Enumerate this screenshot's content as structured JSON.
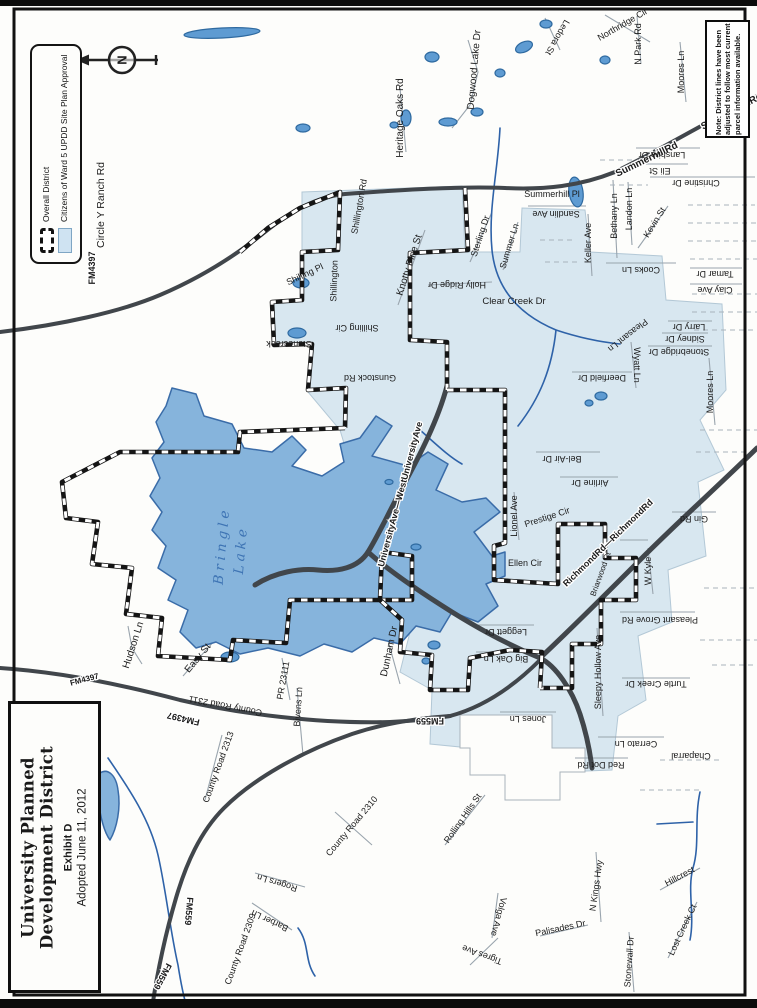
{
  "document": {
    "title_box": {
      "line1": "University Planned",
      "line2": "Development District",
      "exhibit": "Exhibit D",
      "adopted": "Adopted June 11, 2012"
    },
    "legend": {
      "items": [
        {
          "label": "Overall District",
          "swatch": "dashed-boundary"
        },
        {
          "label": "Citizens of Ward 5 UPDD Site Plan Approval",
          "swatch": "light-blue-fill"
        }
      ]
    },
    "note": "Note: District lines have been adjusted to follow most current parcel information available.",
    "north_arrow_letter": "N",
    "lake_label": "Bringle Lake",
    "colors": {
      "district_fill": "#d8e7f0",
      "lake_fill": "#86b4dc",
      "lake_stroke": "#3a6ca8",
      "road": "#41464b",
      "creek": "#2e62a8",
      "label": "#1b1b1b"
    },
    "street_labels": [
      {
        "t": "Circle Y Ranch Rd",
        "x": 104,
        "y": 205,
        "r": -90,
        "s": 10.5
      },
      {
        "t": "FM4397",
        "x": 95,
        "y": 268,
        "r": -90,
        "s": 9,
        "h": 1
      },
      {
        "t": "Heritage Oaks Rd",
        "x": 403,
        "y": 118,
        "r": -90
      },
      {
        "t": "Dogwood  Lake Dr",
        "x": 477,
        "y": 70,
        "r": -85
      },
      {
        "t": "Ledora St",
        "x": 555,
        "y": 36,
        "r": 120,
        "s": 9
      },
      {
        "t": "Northridge Cir",
        "x": 624,
        "y": 27,
        "r": -30,
        "s": 9
      },
      {
        "t": "N Park Rd",
        "x": 641,
        "y": 44,
        "r": -90,
        "s": 9
      },
      {
        "t": "Moores Ln",
        "x": 684,
        "y": 72,
        "r": -90,
        "s": 9
      },
      {
        "t": "SummerhillRd",
        "x": 648,
        "y": 162,
        "r": -26,
        "s": 10,
        "h": 1
      },
      {
        "t": "SummerhillRd",
        "x": 733,
        "y": 114,
        "r": -28,
        "s": 10,
        "h": 1
      },
      {
        "t": "Lanshire Dr",
        "x": 662,
        "y": 152,
        "r": 180,
        "s": 9
      },
      {
        "t": "Eli St",
        "x": 660,
        "y": 168,
        "r": 180,
        "s": 9
      },
      {
        "t": "Christine Dr",
        "x": 696,
        "y": 180,
        "r": 180,
        "s": 9
      },
      {
        "t": "Summerhill Pl",
        "x": 552,
        "y": 197,
        "r": 0,
        "s": 9
      },
      {
        "t": "Sandlin Ave",
        "x": 556,
        "y": 211,
        "r": 180,
        "s": 9
      },
      {
        "t": "Bethany Ln",
        "x": 617,
        "y": 216,
        "r": -90,
        "s": 9
      },
      {
        "t": "Landon Ln",
        "x": 632,
        "y": 209,
        "r": -90,
        "s": 9
      },
      {
        "t": "Kevin St",
        "x": 657,
        "y": 224,
        "r": -58,
        "s": 9
      },
      {
        "t": "Keller Ave",
        "x": 591,
        "y": 243,
        "r": -90,
        "s": 9
      },
      {
        "t": "Cooks Ln",
        "x": 641,
        "y": 267,
        "r": 180,
        "s": 9
      },
      {
        "t": "Tamar Dr",
        "x": 715,
        "y": 271,
        "r": 180,
        "s": 9
      },
      {
        "t": "Clay Ave",
        "x": 715,
        "y": 287,
        "r": 180,
        "s": 9
      },
      {
        "t": "Knotty Pine St",
        "x": 412,
        "y": 266,
        "r": -72
      },
      {
        "t": "Holly Ridge Dr",
        "x": 457,
        "y": 282,
        "r": 180,
        "s": 9
      },
      {
        "t": "Clear Creek Dr",
        "x": 514,
        "y": 304,
        "r": 0,
        "s": 9.5
      },
      {
        "t": "Sterling Dr",
        "x": 483,
        "y": 237,
        "r": -72,
        "s": 9
      },
      {
        "t": "Summer Ln",
        "x": 512,
        "y": 247,
        "r": -73,
        "s": 9
      },
      {
        "t": "Shillington Rd",
        "x": 362,
        "y": 207,
        "r": -80,
        "s": 9
      },
      {
        "t": "Shillington",
        "x": 337,
        "y": 281,
        "r": -88,
        "s": 9
      },
      {
        "t": "Shilling Pl",
        "x": 306,
        "y": 277,
        "r": -25,
        "s": 9
      },
      {
        "t": "Shilling Cir",
        "x": 357,
        "y": 325,
        "r": 180,
        "s": 9
      },
      {
        "t": "Stonecreek",
        "x": 289,
        "y": 341,
        "r": 180,
        "s": 9
      },
      {
        "t": "Gunstock Rd",
        "x": 370,
        "y": 375,
        "r": 180,
        "s": 9
      },
      {
        "t": "Larry Dr",
        "x": 689,
        "y": 324,
        "r": 180,
        "s": 9
      },
      {
        "t": "Sidney Dr",
        "x": 685,
        "y": 336,
        "r": 180,
        "s": 9
      },
      {
        "t": "Stonebridge Dr",
        "x": 679,
        "y": 349,
        "r": 180,
        "s": 9
      },
      {
        "t": "Pleasant Ln",
        "x": 626,
        "y": 333,
        "r": 142,
        "s": 9
      },
      {
        "t": "Wyatt Ln",
        "x": 634,
        "y": 365,
        "r": 90,
        "s": 9
      },
      {
        "t": "Deerfield Dr",
        "x": 602,
        "y": 375,
        "r": 180,
        "s": 9
      },
      {
        "t": "Moores Ln",
        "x": 713,
        "y": 392,
        "r": -90,
        "s": 9
      },
      {
        "t": "Bel-Air Dr",
        "x": 562,
        "y": 456,
        "r": 180,
        "s": 9
      },
      {
        "t": "Airline Dr",
        "x": 590,
        "y": 480,
        "r": 180,
        "s": 9
      },
      {
        "t": "UniversityAve—WestUniversityAve",
        "x": 403,
        "y": 495,
        "r": -75,
        "s": 9,
        "h": 1
      },
      {
        "t": "Lionel Ave",
        "x": 517,
        "y": 516,
        "r": -90,
        "s": 9
      },
      {
        "t": "Prestige Cir",
        "x": 548,
        "y": 520,
        "r": -18,
        "s": 9
      },
      {
        "t": "Ellen Cir",
        "x": 525,
        "y": 566,
        "r": 0,
        "s": 9
      },
      {
        "t": "RichmondRd—RichmondRd",
        "x": 610,
        "y": 545,
        "r": -44,
        "s": 9,
        "h": 1
      },
      {
        "t": "Briarwood Ct",
        "x": 603,
        "y": 575,
        "r": -70,
        "s": 8
      },
      {
        "t": "Gin Rd",
        "x": 694,
        "y": 516,
        "r": 180,
        "s": 9
      },
      {
        "t": "W Kyle",
        "x": 651,
        "y": 571,
        "r": -90,
        "s": 9
      },
      {
        "t": "Pleasant Grove Rd",
        "x": 660,
        "y": 617,
        "r": 180,
        "s": 9
      },
      {
        "t": "Turtle Creek Dr",
        "x": 656,
        "y": 681,
        "r": 180,
        "s": 9
      },
      {
        "t": "Sleepy Hollow Ave",
        "x": 601,
        "y": 672,
        "r": -90,
        "s": 9
      },
      {
        "t": "Jones Ln",
        "x": 528,
        "y": 716,
        "r": 180,
        "s": 9
      },
      {
        "t": "Cerrato Ln",
        "x": 636,
        "y": 741,
        "r": 180,
        "s": 9
      },
      {
        "t": "Chaparral",
        "x": 691,
        "y": 753,
        "r": 180,
        "s": 9
      },
      {
        "t": "Red Dot Rd",
        "x": 601,
        "y": 762,
        "r": 180,
        "s": 9
      },
      {
        "t": "Big Oak Ln",
        "x": 506,
        "y": 656,
        "r": 180,
        "s": 9
      },
      {
        "t": "Leggett Dr",
        "x": 506,
        "y": 629,
        "r": 180,
        "s": 9
      },
      {
        "t": "Dunham Dr",
        "x": 392,
        "y": 652,
        "r": -78
      },
      {
        "t": "FM559",
        "x": 430,
        "y": 718,
        "r": 180,
        "s": 9,
        "h": 1
      },
      {
        "t": "FM559",
        "x": 186,
        "y": 911,
        "r": 95,
        "s": 9,
        "h": 1
      },
      {
        "t": "FM559",
        "x": 160,
        "y": 975,
        "r": 118,
        "s": 9,
        "h": 1
      },
      {
        "t": "FM4397",
        "x": 184,
        "y": 716,
        "r": 193,
        "s": 9,
        "h": 1
      },
      {
        "t": "County Road 2311",
        "x": 226,
        "y": 703,
        "r": 191,
        "s": 9
      },
      {
        "t": "FM4397",
        "x": 85,
        "y": 682,
        "r": -15,
        "s": 8,
        "h": 1
      },
      {
        "t": "PR 23111",
        "x": 286,
        "y": 681,
        "r": -80,
        "s": 9
      },
      {
        "t": "Bivens Ln",
        "x": 301,
        "y": 707,
        "r": -86,
        "s": 9
      },
      {
        "t": "Easy St",
        "x": 200,
        "y": 660,
        "r": -50
      },
      {
        "t": "Hudson Ln",
        "x": 136,
        "y": 646,
        "r": -72
      },
      {
        "t": "County Road 2313",
        "x": 221,
        "y": 768,
        "r": -70,
        "s": 9
      },
      {
        "t": "County Road 2309",
        "x": 243,
        "y": 950,
        "r": -70,
        "s": 9
      },
      {
        "t": "Rogers Ln",
        "x": 278,
        "y": 880,
        "r": 197,
        "s": 9
      },
      {
        "t": "Barber Ln",
        "x": 271,
        "y": 918,
        "r": 205,
        "s": 9
      },
      {
        "t": "County Road 2310",
        "x": 354,
        "y": 828,
        "r": -50,
        "s": 9
      },
      {
        "t": "Rolling Hills St",
        "x": 465,
        "y": 820,
        "r": -55,
        "s": 9
      },
      {
        "t": "Tigres Ave",
        "x": 483,
        "y": 952,
        "r": 200,
        "s": 9
      },
      {
        "t": "Volga Ave",
        "x": 496,
        "y": 916,
        "r": 105,
        "s": 9
      },
      {
        "t": "Palisades Dr",
        "x": 561,
        "y": 931,
        "r": -12,
        "s": 9
      },
      {
        "t": "N Kings Hwy",
        "x": 599,
        "y": 886,
        "r": -82,
        "s": 9
      },
      {
        "t": "Stonewall Dr",
        "x": 632,
        "y": 962,
        "r": -86,
        "s": 9
      },
      {
        "t": "Lost Creek Ct",
        "x": 685,
        "y": 931,
        "r": -65,
        "s": 9
      },
      {
        "t": "Hillcrest",
        "x": 681,
        "y": 879,
        "r": -28,
        "s": 9
      }
    ]
  }
}
